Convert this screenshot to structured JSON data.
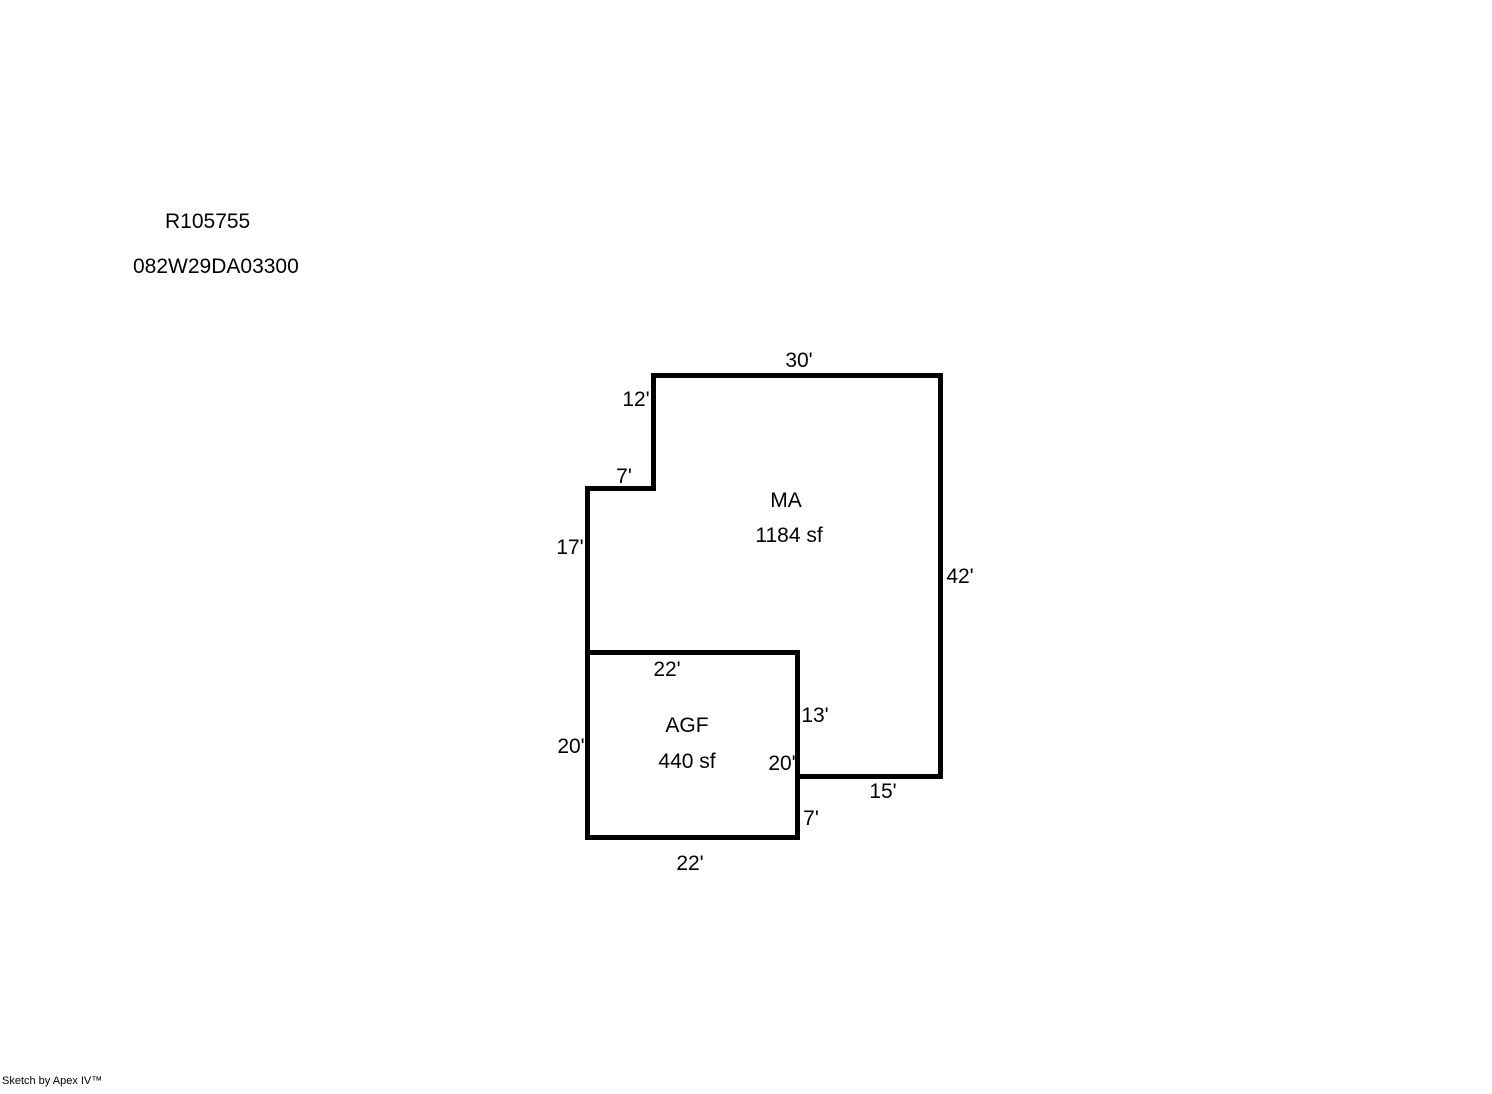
{
  "header": {
    "line1": "R105755",
    "line2": "082W29DA03300"
  },
  "sketch": {
    "areas": {
      "ma": {
        "name": "MA",
        "size": "1184 sf"
      },
      "agf": {
        "name": "AGF",
        "size": "440 sf"
      }
    },
    "dims": {
      "top": "30'",
      "notch_vertical": "12'",
      "notch_horizontal": "7'",
      "left_upper": "17'",
      "right": "42'",
      "agf_top": "22'",
      "agf_left": "20'",
      "agf_right_upper": "13'",
      "agf_right_inner": "20'",
      "ma_bottom": "15'",
      "agf_right_lower": "7'",
      "agf_bottom": "22'"
    },
    "line_color": "#000000",
    "background_color": "#ffffff"
  },
  "footer": {
    "credit": "Sketch by Apex IV™"
  }
}
